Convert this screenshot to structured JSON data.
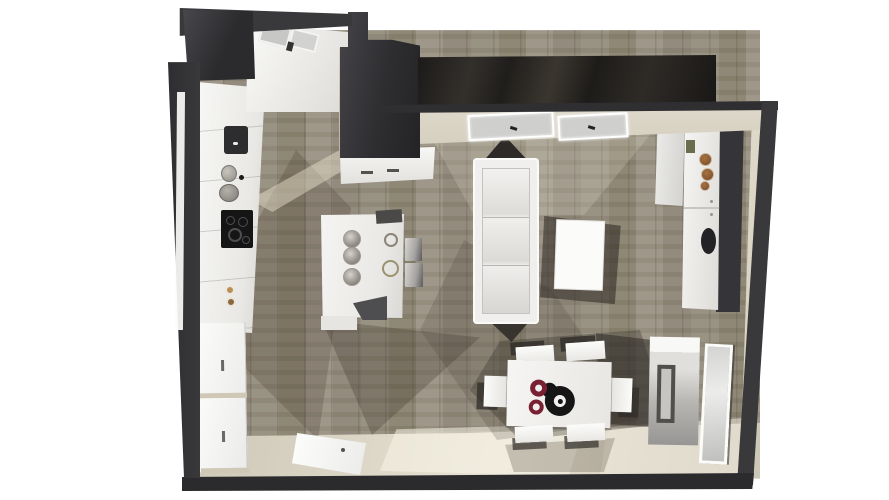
{
  "meta": {
    "description": "Top-down 3D architectural rendering of an open-plan kitchen, living and dining room with dark grey walls, grey-brown wood plank flooring, a beige tiled entry zone, white kitchen units along the left wall, a kitchen island with bar stools, a white three-seat sofa with coffee table, a white dining table with six chairs and a red-and-black centerpiece, wardrobes and a sideboard on the right wall, skylight windows in the top wall and doors at the lower left."
  },
  "palette": {
    "background": "#ffffff",
    "wall": "#39383b",
    "wall_dark": "#2b2a2d",
    "gloss_band_dark": "#191716",
    "wood_floor": "#948d7d",
    "wood_plank_alt": "#89826f",
    "tile_floor": "#d9d3c3",
    "tile_highlight": "#e8e3d4",
    "ledge": "#d6d0c0",
    "furniture_white": "#f4f3f1",
    "furniture_shadow": "#d9d8d5",
    "steel": "#aeaaa3",
    "cooktop": "#151515",
    "accent_red": "#7a2033",
    "decor_brown": "#8a5a33",
    "decor_dark_vase": "#232225",
    "stool_dark": "#4e4d50",
    "shadow_brown": "#4a4034"
  },
  "objects": {
    "room_type": "open-plan kitchen with living and dining area",
    "view": "top-down 3D render",
    "furniture": [
      "kitchen counter with cooktop and pots",
      "upper kitchen cabinets with glass doors",
      "tall dark corner unit and chimney block",
      "base cabinet under chimney",
      "kitchen island with three metal bowls and two wire trivets",
      "two grey bar stools",
      "dark island stool",
      "white three-seat sofa",
      "white coffee table",
      "white dining table with six white chairs",
      "red and black plate centerpiece",
      "right-wall wardrobe and tall cabinet with decorative bowls",
      "dark vase",
      "white sideboard with recessed handle",
      "framed mirror panel",
      "two white doors on lower left wall",
      "open white door lying on tile floor",
      "two skylight windows with spotlights",
      "left wall window slit"
    ]
  }
}
